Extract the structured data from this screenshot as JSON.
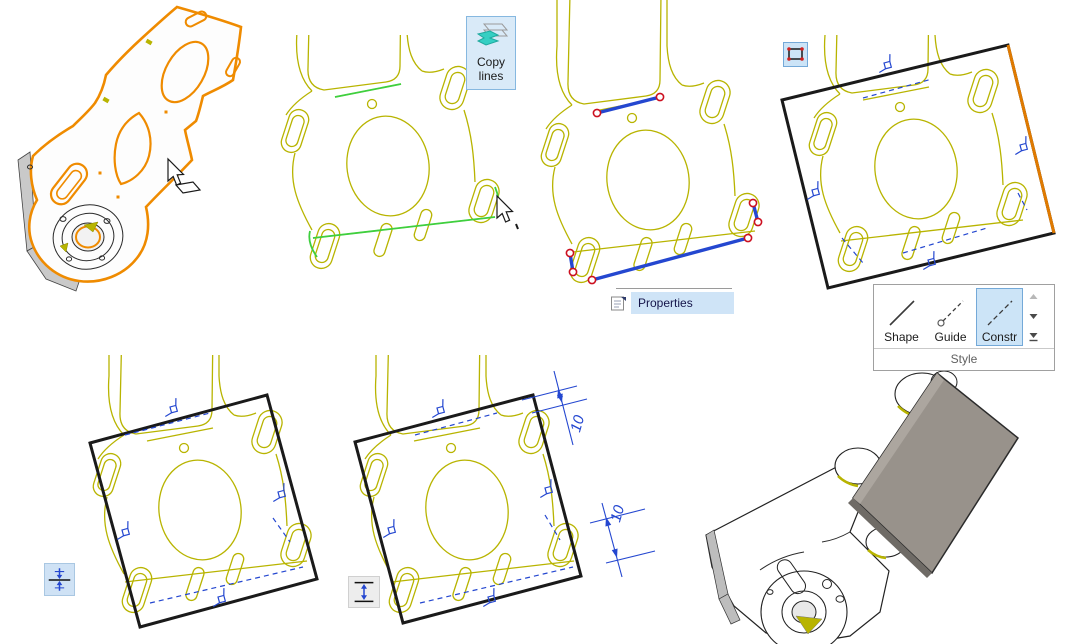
{
  "copy_button": {
    "label": "Copy lines"
  },
  "context_menu": {
    "items": [
      {
        "label": "Properties",
        "highlighted": true
      }
    ]
  },
  "style_panel": {
    "title": "Style",
    "buttons": [
      {
        "label": "Shape",
        "selected": false
      },
      {
        "label": "Guide",
        "selected": false
      },
      {
        "label": "Constr",
        "selected": true
      }
    ]
  },
  "dimensions": [
    "10",
    "10"
  ],
  "icons": {
    "copy_lines": "copy-lines-icon",
    "properties": "properties-icon",
    "rectangle_tool": "rectangle-tool-icon",
    "symmetric_constraint": "symmetric-constraint-icon",
    "vertical_distance": "vertical-distance-icon",
    "shape_line": "shape-line-icon",
    "guide_line": "guide-line-icon",
    "construction_line": "construction-line-icon",
    "scroll_up": "scroll-up-icon",
    "scroll_down": "scroll-down-icon",
    "expand_gallery": "expand-gallery-icon",
    "cursor_face_select": "cursor-face-select-icon",
    "cursor_arrow": "cursor-arrow-icon",
    "perpendicular_constraint": "perpendicular-constraint-glyph"
  },
  "colors": {
    "sketch_olive": "#b8b400",
    "selected_green": "#3ecf3e",
    "highlight_orange": "#ef8b00",
    "construction_blue": "#2447d0",
    "endpoint_red": "#cc1020",
    "rectangle_black": "#1a1a1a",
    "button_blue_bg": "#cce4f7",
    "button_blue_border": "#74a9d8",
    "block_gray": "#98928b"
  }
}
